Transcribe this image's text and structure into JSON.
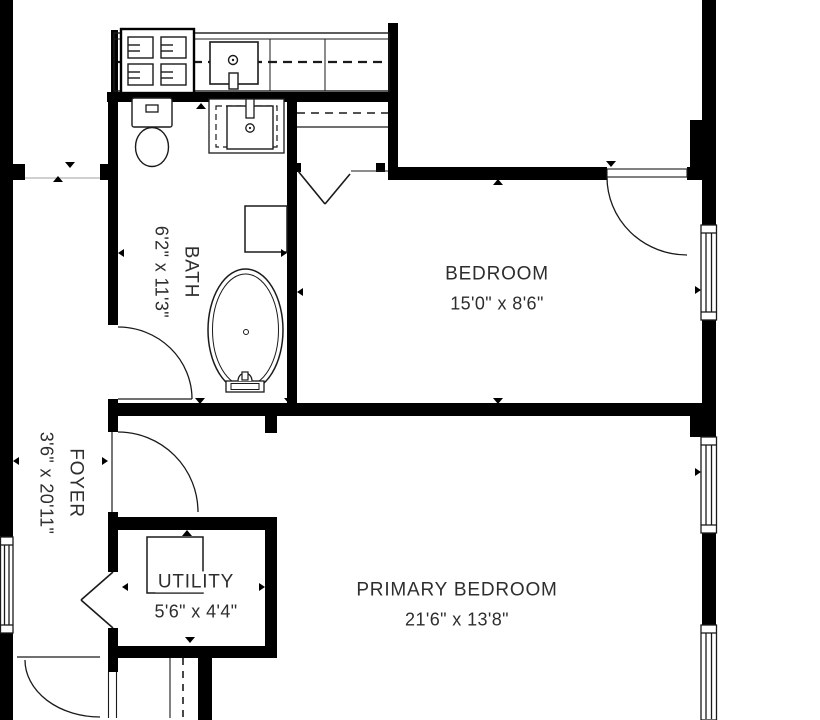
{
  "plan": {
    "type": "floorplan",
    "rooms": [
      {
        "id": "bath",
        "name": "BATH",
        "dims": "6'2\" x 11'3\"",
        "rotated": true
      },
      {
        "id": "foyer",
        "name": "FOYER",
        "dims": "3'6\" x 20'11\"",
        "rotated": true
      },
      {
        "id": "bedroom",
        "name": "BEDROOM",
        "dims": "15'0\" x 8'6\"",
        "rotated": false
      },
      {
        "id": "utility",
        "name": "UTILITY",
        "dims": "5'6\" x 4'4\"",
        "rotated": false
      },
      {
        "id": "primary_bedroom",
        "name": "PRIMARY BEDROOM",
        "dims": "21'6\" x 13'8\"",
        "rotated": false
      }
    ],
    "fixtures": [
      "stove",
      "kitchen-sink",
      "toilet",
      "vanity-sink",
      "bathtub",
      "water-heater",
      "closet-rod"
    ],
    "features": [
      "hinged-doors",
      "bifold-doors",
      "windows",
      "wall-openings",
      "direction-markers"
    ],
    "colors": {
      "wall": "#000000",
      "line": "#1a1a1a",
      "dash": "#1a1a1a",
      "text": "#2e2e2e",
      "bg": "#ffffff"
    }
  }
}
